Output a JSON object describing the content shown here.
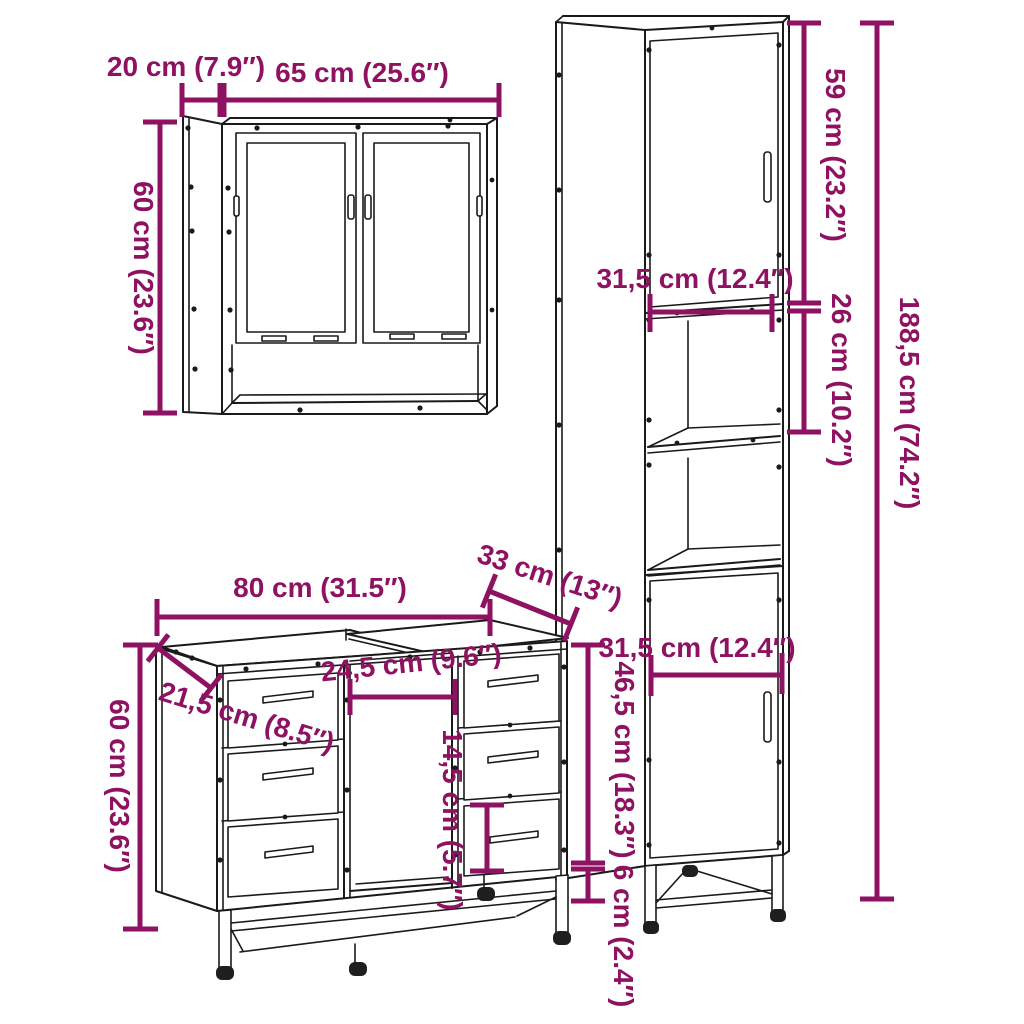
{
  "diagram": {
    "kind": "furniture-dimension-diagram",
    "background": "#ffffff"
  },
  "colors": {
    "dimension": "#8E1162",
    "line": "#1a1a1a"
  },
  "pieces": [
    {
      "id": "mirror-cabinet",
      "dims": {
        "depth": "20 cm (7.9″)",
        "width": "65 cm (25.6″)",
        "height": "60 cm (23.6″)"
      }
    },
    {
      "id": "tall-bathroom-cabinet",
      "dims": {
        "upper_door_height": "59 cm (23.2″)",
        "width_upper": "31,5 cm (12.4″)",
        "open_shelf_height": "26 cm (10.2″)",
        "total_height": "188,5 cm (74.2″)",
        "width_lower": "31,5 cm (12.4″)",
        "lower_door_height": "46,5 cm (18.3″)",
        "ground_clearance": "6 cm (2.4″)"
      }
    },
    {
      "id": "sink-vanity-cabinet",
      "dims": {
        "width": "80 cm (31.5″)",
        "depth": "33 cm (13″)",
        "height": "60 cm (23.6″)",
        "side_depth": "21,5 cm (8.5″)",
        "opening_width": "24,5 cm (9.6″)",
        "drawer_height": "14,5 cm (5.7″)"
      }
    }
  ]
}
